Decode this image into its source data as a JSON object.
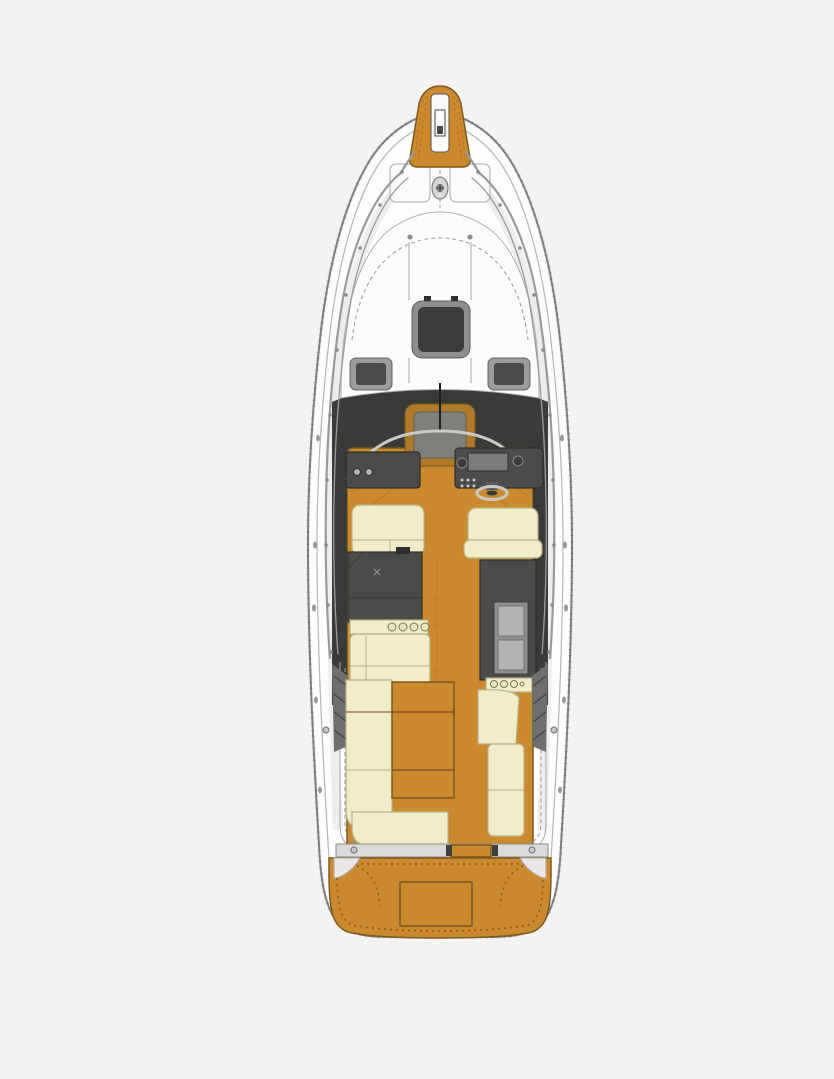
{
  "title": "Motor yacht main deck plan - overhead view",
  "colors": {
    "background": "#f4f3f1",
    "hull": "#fdfdfc",
    "hull_outline": "#7f7f7d",
    "gunwale": "#b5b5b3",
    "deck_line": "#a8a8a6",
    "teak": "#cc8a2e",
    "teak_line": "#7a5a1f",
    "teak_stitch": "#8a5c1a",
    "cream": "#f1edc8",
    "cream_line": "#b5b08a",
    "console": "#4b4b49",
    "console_edge": "#2e2e2c",
    "panel": "#b3b3b1",
    "hatch_frame": "#8e8e8c",
    "hatch_glass": "#3c3c3a",
    "interior_shadow": "#3a3a38",
    "metal": "#c9c9c7",
    "rail": "#9a9a98"
  },
  "parts": {
    "bow_pulpit": "Bow pulpit with anchor locker",
    "foredeck": "Foredeck with hatches and windlass",
    "cabin_roof": "Cabin roof with skylight hatch",
    "windshield": "Wraparound windshield and companionway",
    "helm": "Starboard helm station with wheel and seat",
    "copilot": "Port co-pilot bench and cabinet",
    "galley": "Mid-cabin galley with sink, stove and fridge",
    "cockpit": "Aft cockpit settees and table",
    "transom": "Transom beam with gate",
    "swim_platform": "Teak swim platform with storage hatch"
  }
}
